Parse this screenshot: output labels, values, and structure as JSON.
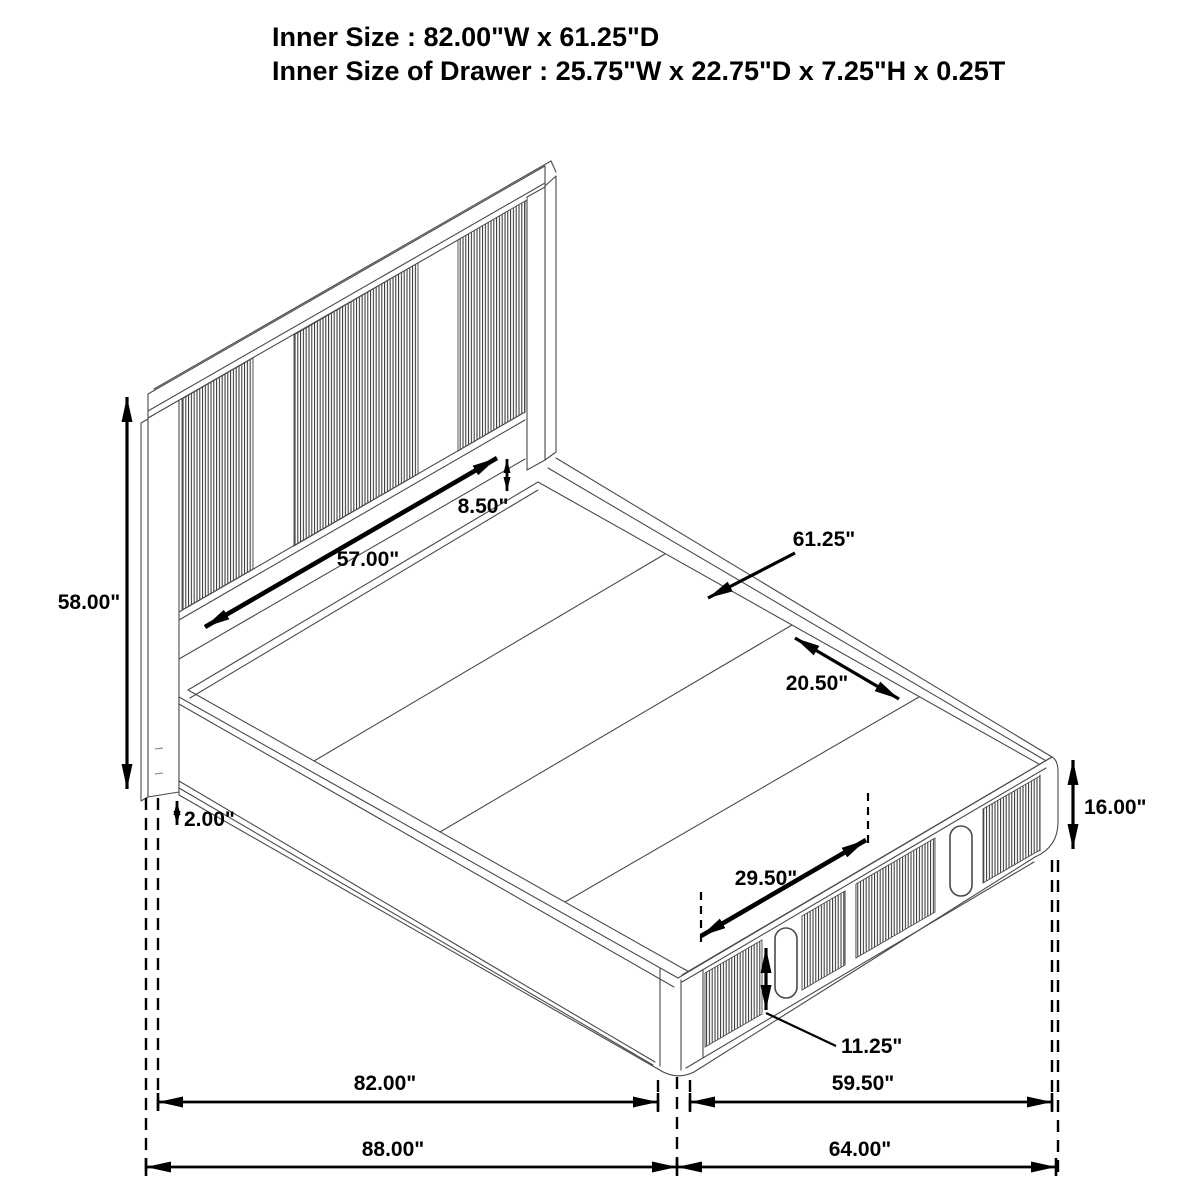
{
  "header": {
    "line1": "Inner Size : 82.00\"W x 61.25\"D",
    "line2": "Inner Size of Drawer : 25.75\"W x 22.75\"D x 7.25\"H x 0.25T"
  },
  "figure": {
    "type": "isometric-line-drawing",
    "subject": "platform storage bed with slatted headboard and footboard drawers"
  },
  "dimensions": {
    "headboard_height": "58.00\"",
    "leg_height": "2.00\"",
    "headboard_rail_height": "8.50\"",
    "headboard_inner_width": "57.00\"",
    "inner_depth": "61.25\"",
    "slat_width": "20.50\"",
    "drawer_width": "29.50\"",
    "handle_height": "11.25\"",
    "platform_height": "16.00\"",
    "inner_length": "82.00\"",
    "drawer_rail_length": "59.50\"",
    "overall_length": "88.00\"",
    "overall_width": "64.00\""
  }
}
